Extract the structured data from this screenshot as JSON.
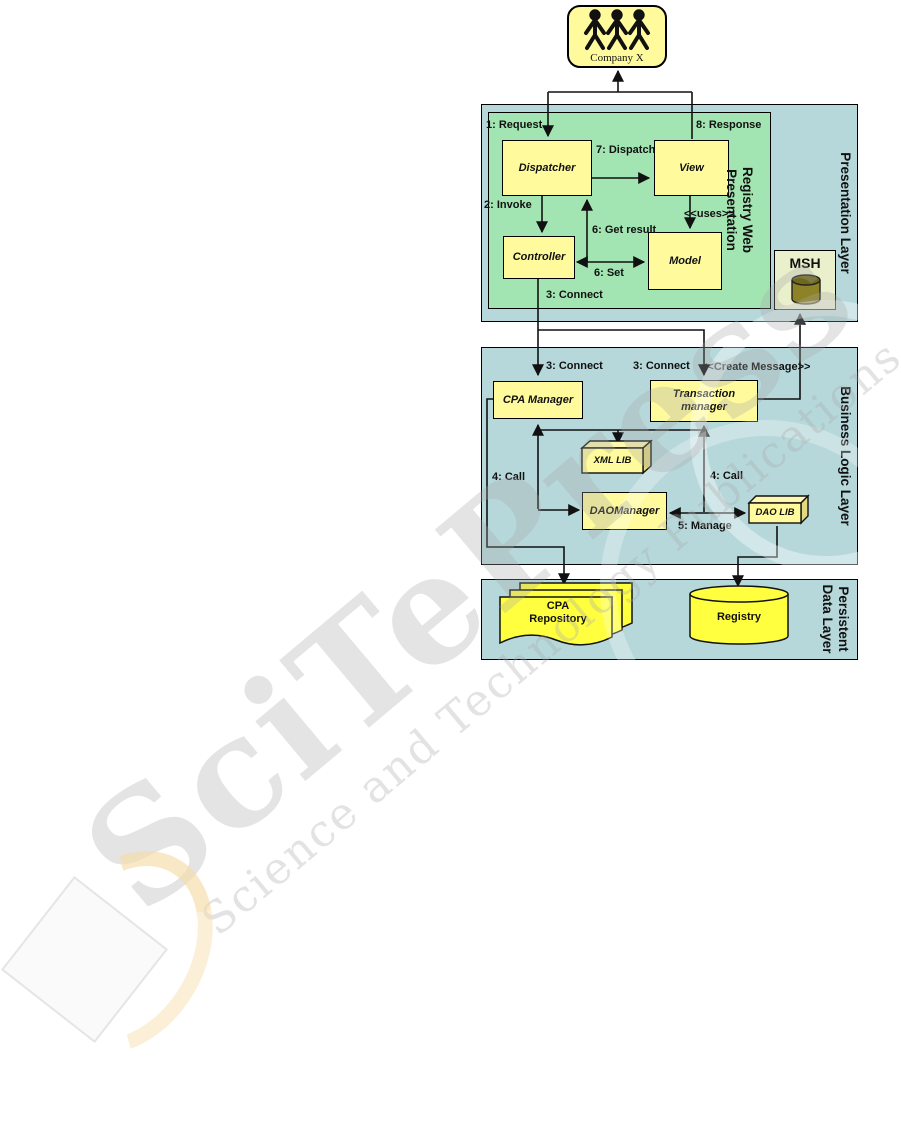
{
  "actor": {
    "label": "Company X"
  },
  "presentation_layer": {
    "label": "Presentation Layer",
    "inner": {
      "line1": "Registry Web",
      "line2": "Presentation"
    },
    "boxes": {
      "dispatcher": "Dispatcher",
      "view": "View",
      "controller": "Controller",
      "model": "Model",
      "msh": "MSH"
    },
    "edges": {
      "request": "1: Request",
      "response": "8: Response",
      "dispatch": "7: Dispatch",
      "invoke": "2: Invoke",
      "get_result": "6: Get result",
      "set": "6: Set",
      "uses": "<<uses>>",
      "connect": "3: Connect"
    }
  },
  "business_layer": {
    "label": "Business Logic Layer",
    "boxes": {
      "cpa_manager": "CPA Manager",
      "transaction_manager": "Transaction manager",
      "xml_lib": "XML LIB",
      "dao_manager": "DAOManager",
      "dao_lib": "DAO LIB"
    },
    "edges": {
      "connect_left": "3: Connect",
      "connect_right": "3: Connect",
      "create_message": "<<Create Message>>",
      "call_left": "4: Call",
      "call_right": "4: Call",
      "manage": "5: Manage"
    }
  },
  "data_layer": {
    "label": {
      "line1": "Persistent",
      "line2": "Data Layer"
    },
    "cpa_repository": "CPA Repository",
    "registry": "Registry"
  },
  "watermark": {
    "title": "SciTePress",
    "subtitle": "Science and Technology Publications"
  },
  "colors": {
    "layer_fill": "#b7d8db",
    "inner_green": "#a2e5b2",
    "class_yellow": "#fffb9d",
    "store_yellow": "#ffff3f",
    "msh_fill": "#eaf0cb",
    "msh_cylinder": "#8d8326"
  }
}
